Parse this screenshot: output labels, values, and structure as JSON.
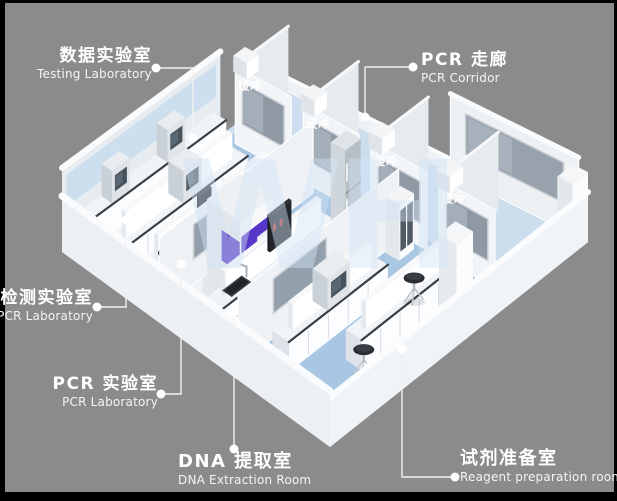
{
  "canvas": {
    "frame_color": "#000000",
    "background_color": "#8b8b8b"
  },
  "watermark_text": "WH",
  "callouts": {
    "testing_lab": {
      "zh": "数据实验室",
      "en": "Testing Laboratory"
    },
    "pcr_corridor": {
      "zh": "PCR 走廊",
      "en": "PCR Corridor"
    },
    "detection_lab": {
      "zh": "检测实验室",
      "en": "PCR Laboratory"
    },
    "pcr_lab": {
      "zh": "PCR 实验室",
      "en": "PCR Laboratory"
    },
    "dna_extraction": {
      "zh": "DNA 提取室",
      "en": "DNA Extraction Room"
    },
    "reagent_prep": {
      "zh": "试剂准备室",
      "en": "Reagent preparation room"
    }
  },
  "buffer_rooms": [
    {
      "label": "缓冲"
    },
    {
      "label": "缓冲"
    },
    {
      "label": "缓冲"
    },
    {
      "label": "缓冲"
    }
  ],
  "colors": {
    "floor_blue": "#a9c6e2",
    "corridor_blue": "#cfe0ef",
    "wall_white": "#f0f3f6",
    "glass_gray": "#8e99a4",
    "counter_dark": "#3a4048",
    "accent_purple": "#5636c8",
    "stool_dark": "#2b2f35",
    "label_white": "#ffffff"
  }
}
